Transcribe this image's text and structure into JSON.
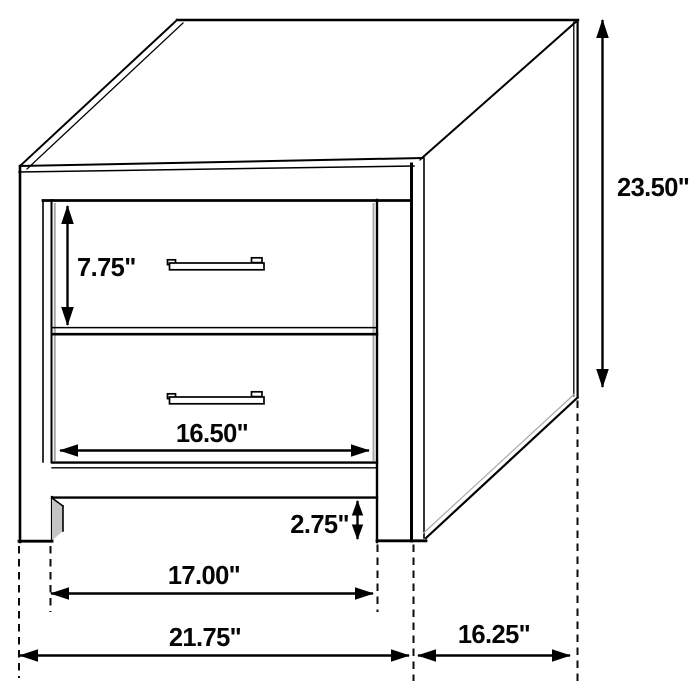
{
  "diagram": {
    "kind": "furniture dimension line drawing",
    "subject": "two-drawer nightstand, isometric front-right view",
    "background_color": "#ffffff",
    "line_color": "#000000",
    "shadow_color": "#a9a9a9",
    "unit": "inches",
    "dimensions": {
      "overall_height": {
        "label": "23.50\"",
        "value": 23.5,
        "measures": "overall height (right side arrow)"
      },
      "drawer_front_height": {
        "label": "7.75\"",
        "value": 7.75,
        "measures": "top drawer front height"
      },
      "drawer_opening_width": {
        "label": "16.50\"",
        "value": 16.5,
        "measures": "drawer opening width"
      },
      "base_clearance": {
        "label": "2.75\"",
        "value": 2.75,
        "measures": "leg / base rail height"
      },
      "inner_leg_span": {
        "label": "17.00\"",
        "value": 17.0,
        "measures": "clear span between legs"
      },
      "overall_width": {
        "label": "21.75\"",
        "value": 21.75,
        "measures": "overall front width"
      },
      "overall_depth": {
        "label": "16.25\"",
        "value": 16.25,
        "measures": "overall side depth"
      }
    }
  }
}
